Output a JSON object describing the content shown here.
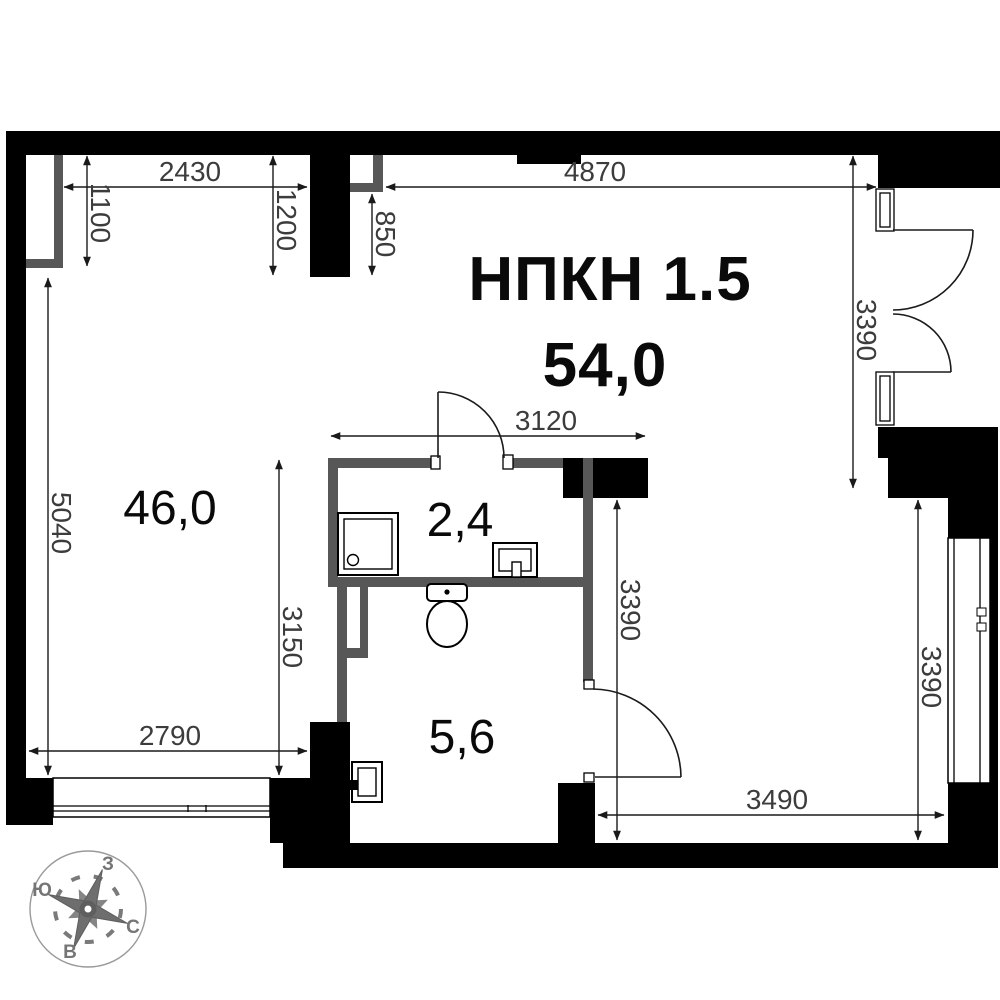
{
  "plan": {
    "unit_label": "НПКН 1.5",
    "total_area": "54,0",
    "rooms": {
      "main": {
        "area": "46,0"
      },
      "bath": {
        "area": "2,4"
      },
      "hall": {
        "area": "5,6"
      }
    },
    "dimensions": {
      "top_left_width": "2430",
      "niche_left_depth": "1100",
      "pier_depth": "1200",
      "niche_top_depth": "850",
      "top_right_width": "4870",
      "entry_opening_height": "3390",
      "bath_width": "3120",
      "main_left_height": "5040",
      "main_lower_height": "3150",
      "main_bottom_width": "2790",
      "hall_wall_height": "3390",
      "window_right_height": "3390",
      "hall_bottom_width": "3490"
    },
    "compass": {
      "west": "З",
      "south": "Ю",
      "north": "С",
      "east": "В"
    },
    "colors": {
      "wall": "#000000",
      "partition": "#575757",
      "dim_text": "#3c3c3c"
    }
  }
}
